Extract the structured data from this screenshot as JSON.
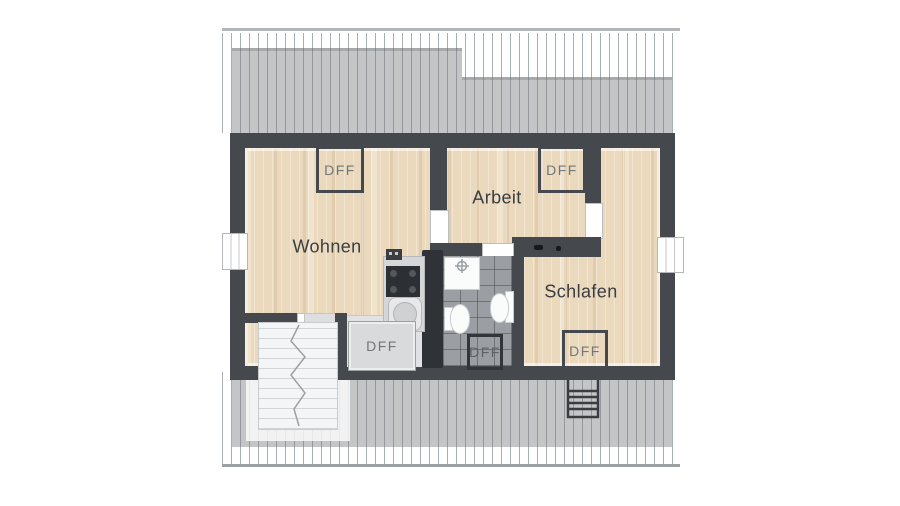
{
  "plan_type": "floor-plan",
  "rooms": [
    {
      "id": "wohnen",
      "label": "Wohnen"
    },
    {
      "id": "arbeit",
      "label": "Arbeit"
    },
    {
      "id": "schlafen",
      "label": "Schlafen"
    }
  ],
  "skylights": [
    {
      "location": "wohnen",
      "label": "DFF"
    },
    {
      "location": "arbeit",
      "label": "DFF"
    },
    {
      "location": "dormer-flur",
      "label": "DFF"
    },
    {
      "location": "bad",
      "label": "DFF"
    },
    {
      "location": "schlafen",
      "label": "DFF"
    }
  ],
  "palette": {
    "wall": "#45484c",
    "wall_dark_core": "#2f3236",
    "wood_floor": "#ead9bd",
    "bath_tile": "#9b9ea2",
    "roof_overlay": "#8b9094",
    "stair_tread": "#f4f5f6",
    "room_label_text": "#3a3d41",
    "dff_text": "#737679"
  }
}
